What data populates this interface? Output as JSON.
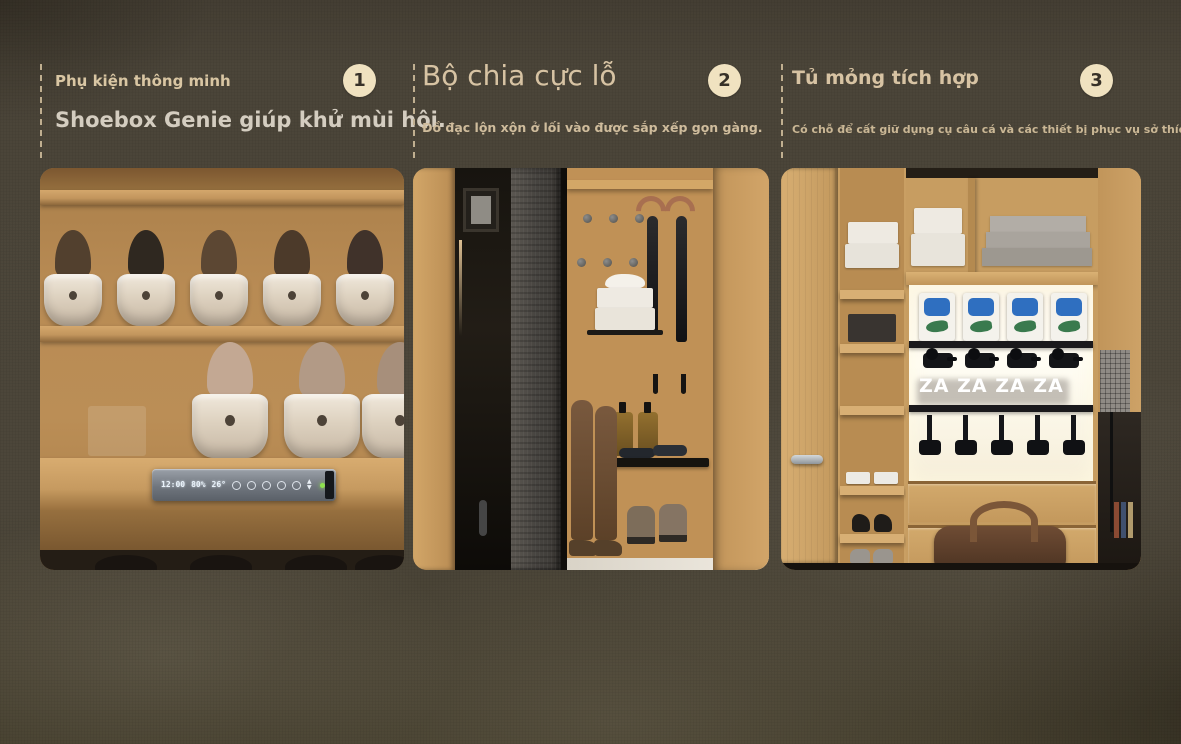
{
  "panels": [
    {
      "badge": "1",
      "title": "Phụ kiện thông minh",
      "subtitle": "Shoebox Genie giúp khử mùi hôi."
    },
    {
      "badge": "2",
      "title": "Bộ chia cực lỗ",
      "subtitle": "Đồ đạc lộn xộn ở lối vào được sắp xếp gọn gàng."
    },
    {
      "badge": "3",
      "title": "Tủ mỏng tích hợp",
      "subtitle": "Có chỗ để cất giữ dụng cụ câu cá và các thiết bị phục vụ sở thích khác."
    }
  ],
  "photos": {
    "shoebox_genie": {
      "control_panel": {
        "time": "12:00",
        "humidity": "80%",
        "temperature": "26°",
        "arrows": "▲ ▼"
      }
    },
    "slim_cabinet": {
      "overlay_text": "ZA ZA ZA ZA"
    }
  },
  "colors": {
    "background": "#4b4438",
    "badge_bg": "#f0e2c0",
    "badge_text": "#373128",
    "heading": "#d7c3a3",
    "subtitle_light": "#d4cdc0",
    "subtitle_tan": "#cfbc9c",
    "power_led": "#8ee14e"
  }
}
